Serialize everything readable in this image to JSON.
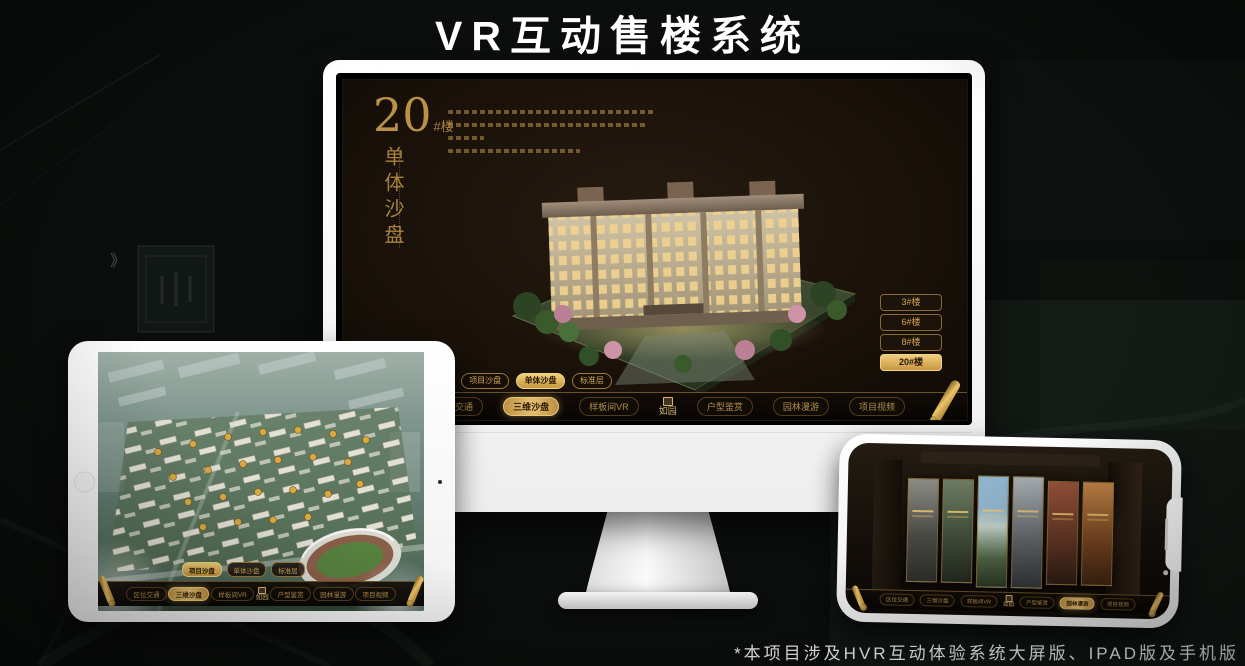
{
  "title": "VR互动售楼系统",
  "footnote": "*本项目涉及HVR互动体验系统大屏版、IPAD版及手机版",
  "brand": {
    "logo": "如园"
  },
  "nav": {
    "items": [
      "区位交通",
      "三维沙盘",
      "样板间VR",
      "户型鉴赏",
      "园林漫游",
      "项目视频"
    ],
    "sub_tabs": [
      "项目沙盘",
      "单体沙盘",
      "标准层"
    ]
  },
  "monitor": {
    "headline_number": "20",
    "headline_unit": "#楼",
    "headline_vertical": "单体沙盘",
    "floor_buttons": [
      {
        "label": "3#楼",
        "active": false
      },
      {
        "label": "6#楼",
        "active": false
      },
      {
        "label": "8#楼",
        "active": false
      },
      {
        "label": "20#楼",
        "active": true
      }
    ],
    "active_sub_tab": "单体沙盘",
    "active_nav_item": "三维沙盘"
  },
  "tablet": {
    "active_sub_tab": "项目沙盘",
    "active_nav_item": "三维沙盘"
  },
  "phone": {
    "active_nav_item": "园林漫游"
  },
  "colors": {
    "gold": "#c79a4b",
    "gold_bright": "#ecc878",
    "screen_brown": "#1b120a",
    "canvas_bg": "#0b0e0c"
  }
}
